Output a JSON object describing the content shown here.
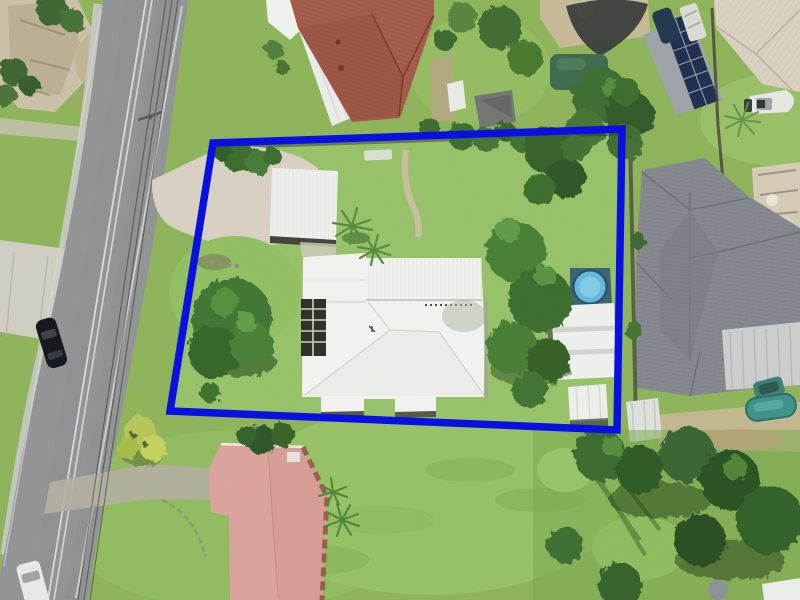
{
  "scene": {
    "type": "aerial-photograph",
    "description": "Aerial drone photo of a suburban block; the subject property is outlined with a thick blue boundary rectangle",
    "boundary": {
      "color": "#0a10e2",
      "points": "213,143 622,129 617,430 170,411",
      "stroke_width": "7.5"
    },
    "features": [
      "road",
      "footpath",
      "rock-outcrop",
      "power-lines",
      "black-car",
      "white-van",
      "subject-driveway",
      "carport",
      "main-house-white-roof",
      "pergola-skylights",
      "garden-path",
      "above-ground-pool",
      "garden-shed",
      "corner-shed",
      "garden-bench",
      "north-neighbor-red-tile-house",
      "north-neighbor-patio-roof",
      "northeast-shade-sail",
      "northeast-green-canopy",
      "solar-panel-shed",
      "boat",
      "northeast-cream-roof-house",
      "east-neighbor-gray-roof-house",
      "east-neighbor-pool",
      "teal-car",
      "south-neighbor-pink-roof-house",
      "yellow-bush",
      "tree-clusters",
      "lawns"
    ]
  },
  "colors": {
    "grass_base": "#8ab158",
    "subject_lawn": "#95c167",
    "road": "#8e9092",
    "footpath": "#c3c6c0",
    "driveway": "#d6cfc0",
    "white_roof": "#f1f2ef",
    "carport_roof": "#eef0ed",
    "north_red_roof": "#a05a49",
    "south_pink_roof": "#d49a92",
    "east_gray_roof": "#82868c",
    "northeast_cream_roof": "#d8d1bf",
    "pool_water": "#5fb7d9",
    "neighbor_pool_water": "#3f8e85",
    "solar_panels": "#202f4d",
    "shade_sail": "#3a3e39",
    "rock_outcrop": "#c9bfa5",
    "black_car": "#15181c",
    "white_van": "#e7e8e4",
    "teal_car": "#3e7a72"
  }
}
